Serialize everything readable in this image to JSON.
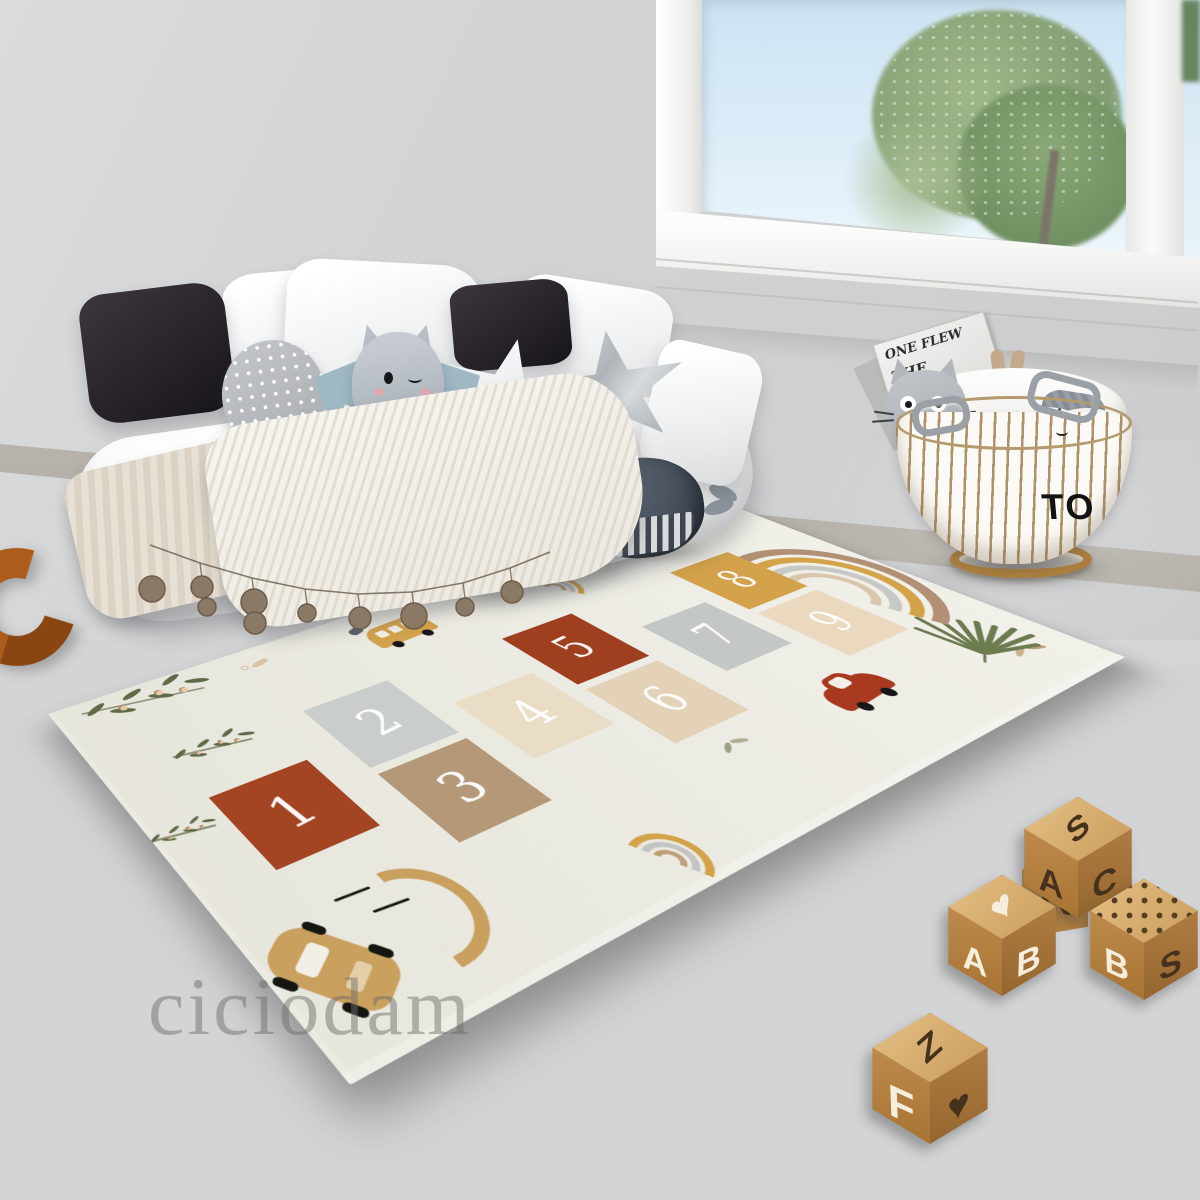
{
  "watermark": {
    "text": "ciciodam"
  },
  "rug": {
    "background": "#ebeae1",
    "number_color": "#ffffff",
    "squares": [
      {
        "number": "1",
        "color": "#a34523",
        "dotted": false
      },
      {
        "number": "2",
        "color": "#c9cdcb",
        "dotted": true
      },
      {
        "number": "3",
        "color": "#b59878",
        "dotted": false
      },
      {
        "number": "4",
        "color": "#e9ddc6",
        "dotted": false
      },
      {
        "number": "5",
        "color": "#9e3f20",
        "dotted": true
      },
      {
        "number": "6",
        "color": "#e3d2b7",
        "dotted": true
      },
      {
        "number": "7",
        "color": "#c3c8c6",
        "dotted": false
      },
      {
        "number": "8",
        "color": "#d3a24b",
        "dotted": false
      },
      {
        "number": "9",
        "color": "#ead9bf",
        "dotted": true
      }
    ],
    "rainbow_colors": [
      "#b29076",
      "#d4a349",
      "#c7c9c6",
      "#d9c6ab"
    ],
    "small_rainbow_colors": [
      "#d4a349",
      "#c2c5c4",
      "#bfa07b"
    ]
  },
  "basket": {
    "label": "TO"
  },
  "book": {
    "lines": [
      "ONE FLEW",
      "THE",
      "O'S"
    ]
  },
  "blocks": {
    "sac": {
      "top": "S",
      "left": "A",
      "right": "C"
    },
    "r": {
      "face": "R"
    },
    "heart": {
      "top": "♥",
      "left": "A",
      "right": "B"
    },
    "bs": {
      "left": "B",
      "right": "S"
    },
    "fz": {
      "top": "Z",
      "left": "F",
      "right": "♥"
    }
  },
  "palette": {
    "wall": "#d3d4d5",
    "floor": "#96989b",
    "rug": "#ebeae1",
    "rust": "#a34523",
    "mustard": "#d3a24b",
    "wood": "#c08c4d",
    "basket_base": "#a97e3e",
    "sky": "#d6e9f5",
    "whale": "#47505c"
  }
}
